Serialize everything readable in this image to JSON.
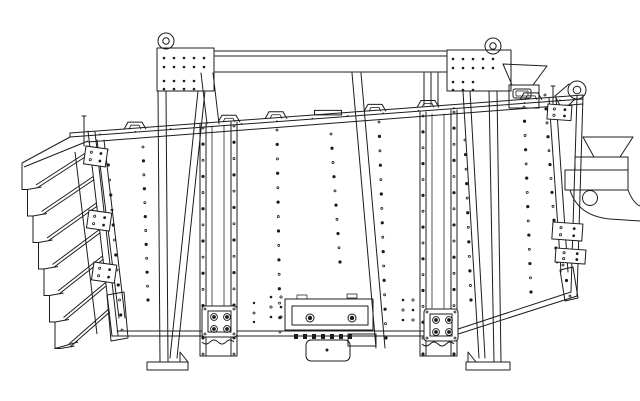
{
  "meta": {
    "description": "black-and-white CAD side-elevation line drawing of an industrial gyratory sifter screening machine",
    "colors": {
      "background": "#ffffff",
      "line": "#1c1c1c"
    },
    "components": [
      "top-cross-beam",
      "left-support-stand",
      "right-support-stand",
      "lifting-eye-left",
      "lifting-eye-right",
      "screen-box-body",
      "top-rim-clamp-handles",
      "feed-inlet-hopper",
      "right-discharge-spout",
      "discharge-support-bracket",
      "left-discharge-chute-stack",
      "left-end-clamp-rail",
      "right-end-clamp-rail",
      "left-guide-rail-drive-flange",
      "right-guide-rail-drive-flange",
      "drive-motor",
      "bottom-access-panel",
      "foot-plates",
      "bolt-hole-patterns"
    ]
  },
  "drawing": {
    "rim": {
      "x1": 70,
      "y1": 133,
      "x2": 583,
      "y2": 95
    },
    "rim_dot_row": {
      "x_start": 100,
      "x_end": 560,
      "n": 14,
      "r": 0.8,
      "y_offset": 3.5
    },
    "rim_handles": {
      "centers": [
        135,
        229,
        276,
        375,
        428,
        531
      ],
      "width": 22,
      "height": 7,
      "flat_plate": {
        "center": 328,
        "width": 27,
        "height": 4.5
      }
    },
    "dot_columns": [
      {
        "name": "left-end-rail-bolts",
        "x1": 107,
        "y1": 150,
        "x2": 122,
        "y2": 330,
        "n": 13
      },
      {
        "name": "face-col-left",
        "x1": 143,
        "y1": 147,
        "x2": 148,
        "y2": 300,
        "n": 12
      },
      {
        "name": "left-rail-left-bolts",
        "x1": 203,
        "y1": 128,
        "x2": 203,
        "y2": 354,
        "n": 15
      },
      {
        "name": "left-rail-right-bolts",
        "x1": 234,
        "y1": 126,
        "x2": 234,
        "y2": 354,
        "n": 15
      },
      {
        "name": "face-col-a",
        "x1": 277,
        "y1": 130,
        "x2": 280,
        "y2": 332,
        "n": 15
      },
      {
        "name": "face-col-b",
        "x1": 331,
        "y1": 134,
        "x2": 340,
        "y2": 262,
        "n": 10
      },
      {
        "name": "face-col-c",
        "x1": 379,
        "y1": 122,
        "x2": 386,
        "y2": 338,
        "n": 16
      },
      {
        "name": "right-rail-left-bolts",
        "x1": 423,
        "y1": 116,
        "x2": 423,
        "y2": 354,
        "n": 16
      },
      {
        "name": "right-rail-right-bolts",
        "x1": 454,
        "y1": 112,
        "x2": 454,
        "y2": 354,
        "n": 16
      },
      {
        "name": "face-col-d",
        "x1": 465,
        "y1": 140,
        "x2": 471,
        "y2": 300,
        "n": 12
      },
      {
        "name": "face-col-e",
        "x1": 524,
        "y1": 107,
        "x2": 531,
        "y2": 292,
        "n": 14
      },
      {
        "name": "right-end-rail-bolts",
        "x1": 545,
        "y1": 95,
        "x2": 557,
        "y2": 262,
        "n": 13
      },
      {
        "name": "right-end-lower-bolts",
        "x1": 563,
        "y1": 265,
        "x2": 570,
        "y2": 296,
        "n": 3
      }
    ],
    "bolt_clusters": [
      {
        "name": "panel-left-bolts",
        "cols": [
          271,
          281
        ],
        "rows": [
          297,
          307,
          317
        ],
        "r": 1.3
      },
      {
        "name": "panel-right-bolts",
        "cols": [
          403,
          413
        ],
        "rows": [
          300,
          310,
          320
        ],
        "r": 1.3
      },
      {
        "name": "panel-far-left-bolts",
        "cols": [
          254
        ],
        "rows": [
          303,
          313,
          322
        ],
        "r": 1.2
      }
    ],
    "plate_grids": [
      {
        "name": "left-plate-bolts",
        "groups": [
          {
            "cols": [
              164,
              174,
              184,
              194,
              204
            ],
            "rows": [
              58,
              67
            ]
          },
          {
            "cols": [
              164,
              174,
              184,
              194
            ],
            "rows": [
              81,
              89
            ]
          }
        ],
        "r": 1.3
      },
      {
        "name": "right-plate-bolts",
        "groups": [
          {
            "cols": [
              453,
              463,
              473,
              483,
              493
            ],
            "rows": [
              59,
              68
            ]
          },
          {
            "cols": [
              453,
              463,
              473
            ],
            "rows": [
              82,
              90
            ]
          }
        ],
        "r": 1.3
      }
    ],
    "flanges": [
      {
        "name": "left-drive-flange",
        "x": 202,
        "y": 306,
        "w": 35,
        "h": 31,
        "bolts": [
          [
            214,
            317
          ],
          [
            227,
            317
          ],
          [
            214,
            329
          ],
          [
            227,
            329
          ]
        ],
        "corners": [
          [
            205,
            309
          ],
          [
            234,
            309
          ],
          [
            205,
            334
          ],
          [
            234,
            334
          ]
        ],
        "wave_y": 342,
        "wave_x": 202
      },
      {
        "name": "right-drive-flange",
        "x": 424,
        "y": 309,
        "w": 34,
        "h": 32,
        "bolts": [
          [
            436,
            320
          ],
          [
            449,
            320
          ],
          [
            436,
            332
          ],
          [
            449,
            332
          ]
        ],
        "corners": [
          [
            427,
            312
          ],
          [
            455,
            312
          ],
          [
            427,
            338
          ],
          [
            455,
            338
          ]
        ],
        "wave_y": 344,
        "wave_x": 422
      }
    ],
    "clamp_plates": [
      {
        "name": "left-end-clamp-1",
        "x": 86,
        "y": 146,
        "w": 22,
        "h": 18,
        "rot": 8
      },
      {
        "name": "left-end-clamp-2",
        "x": 89,
        "y": 210,
        "w": 23,
        "h": 18,
        "rot": 8
      },
      {
        "name": "left-end-clamp-3",
        "x": 94,
        "y": 262,
        "w": 23,
        "h": 18,
        "rot": 8
      },
      {
        "name": "right-end-clamp-1",
        "x": 548,
        "y": 104,
        "w": 24,
        "h": 15,
        "rot": 4
      },
      {
        "name": "right-end-clamp-2",
        "x": 553,
        "y": 222,
        "w": 30,
        "h": 17,
        "rot": 4
      },
      {
        "name": "right-end-clamp-3",
        "x": 556,
        "y": 248,
        "w": 30,
        "h": 14,
        "rot": 4
      }
    ],
    "chutes": {
      "count": 7,
      "tooth_x0": 22,
      "tooth_dx": 5.5,
      "y0": 163,
      "dy": 26.5,
      "diag_x0": 90.2,
      "diag_dx": 3.09,
      "diag_y0": 150,
      "diag_end_x0": 36,
      "lip": 14
    },
    "motor_bolts": {
      "xs": [
        294,
        303,
        312,
        321,
        330,
        339,
        348
      ],
      "y": 334,
      "w": 4,
      "h": 5
    },
    "eyes": [
      {
        "name": "lifting-eye-left",
        "cx": 166,
        "cy": 41,
        "r": 8,
        "ir": 3.2
      },
      {
        "name": "lifting-eye-right",
        "cx": 493,
        "cy": 46,
        "r": 8,
        "ir": 3.2
      },
      {
        "name": "lifting-eye-corner",
        "cx": 577,
        "cy": 90,
        "r": 9,
        "ir": 3.8
      }
    ]
  }
}
